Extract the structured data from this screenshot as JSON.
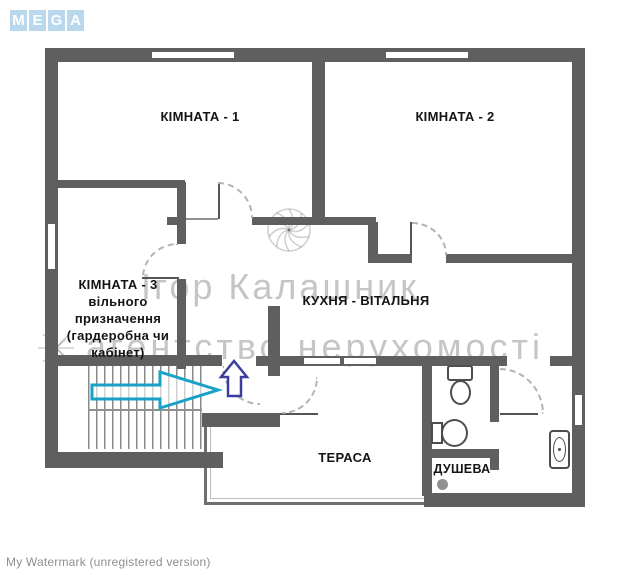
{
  "logo": {
    "brand": "MEGA",
    "letters": [
      "M",
      "E",
      "G",
      "A"
    ],
    "tile_color": "#b9d8ee"
  },
  "floor_plan": {
    "rooms": {
      "room1": {
        "label": "КІМНАТА - 1"
      },
      "room2": {
        "label": "КІМНАТА - 2"
      },
      "room3": {
        "label": "КІМНАТА - 3\nвільного\nпризначення\n(гардеробна чи\nкабінет)"
      },
      "kitchen": {
        "label": "КУХНЯ - ВІТАЛЬНЯ"
      },
      "terrace": {
        "label": "ТЕРАСА"
      },
      "shower": {
        "label": "ДУШЕВА"
      }
    },
    "annotations": {
      "entrance_arrow_color": "#18a2c8",
      "up_arrow_color": "#3a3f9d"
    }
  },
  "watermark": {
    "center_name": "Ігор Калашник",
    "center_subtitle": "агентство нерухомості",
    "bottom_text": "My Watermark (unregistered version)"
  }
}
